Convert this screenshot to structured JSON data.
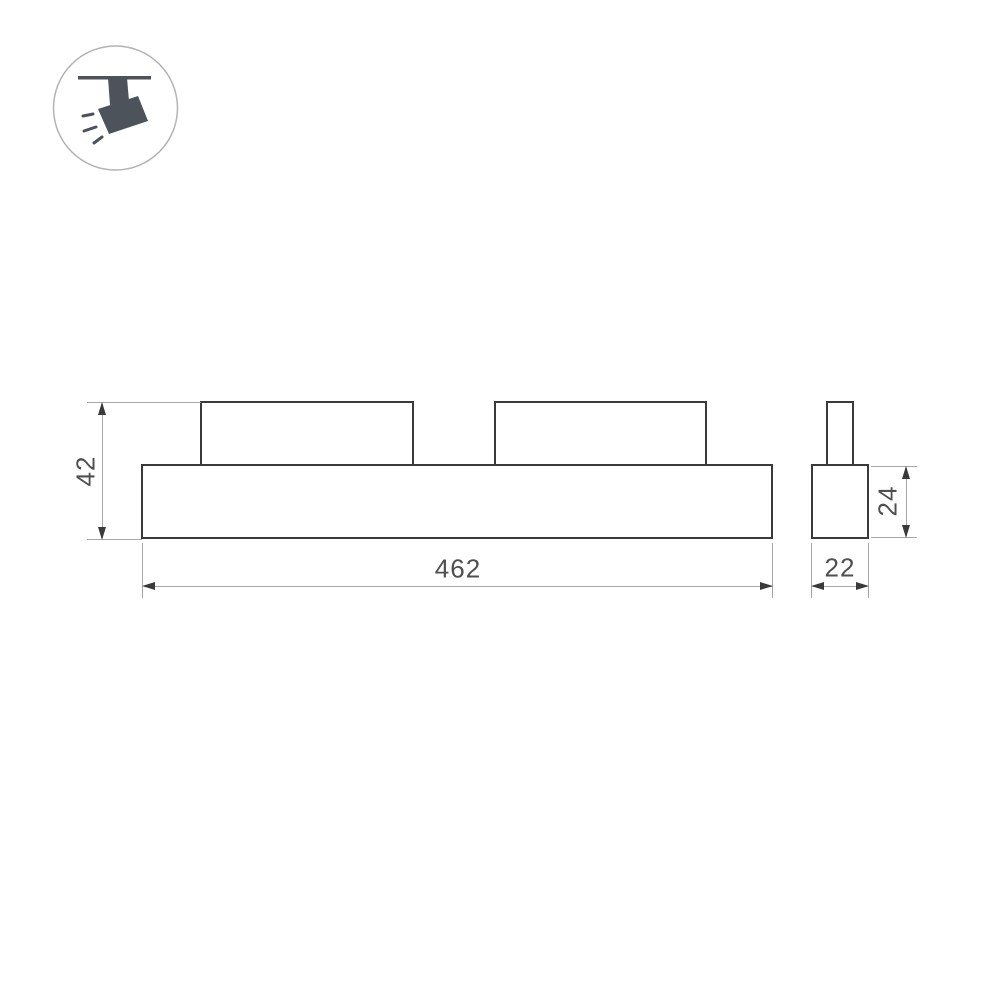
{
  "drawing": {
    "title": "track-mounted linear luminaire dimension drawing",
    "front_view": {
      "height_label": "42",
      "width_label": "462"
    },
    "side_view": {
      "height_label": "24",
      "width_label": "22"
    },
    "icon": "track-spotlight",
    "colors": {
      "outline": "#3a3a3a",
      "dimension_line": "#a6a6a6",
      "arrowhead": "#3a3a3a",
      "text": "#4f4f4f",
      "icon_fill": "#4c535a",
      "icon_circle_stroke": "#b4b4b4",
      "background": "#ffffff"
    }
  }
}
